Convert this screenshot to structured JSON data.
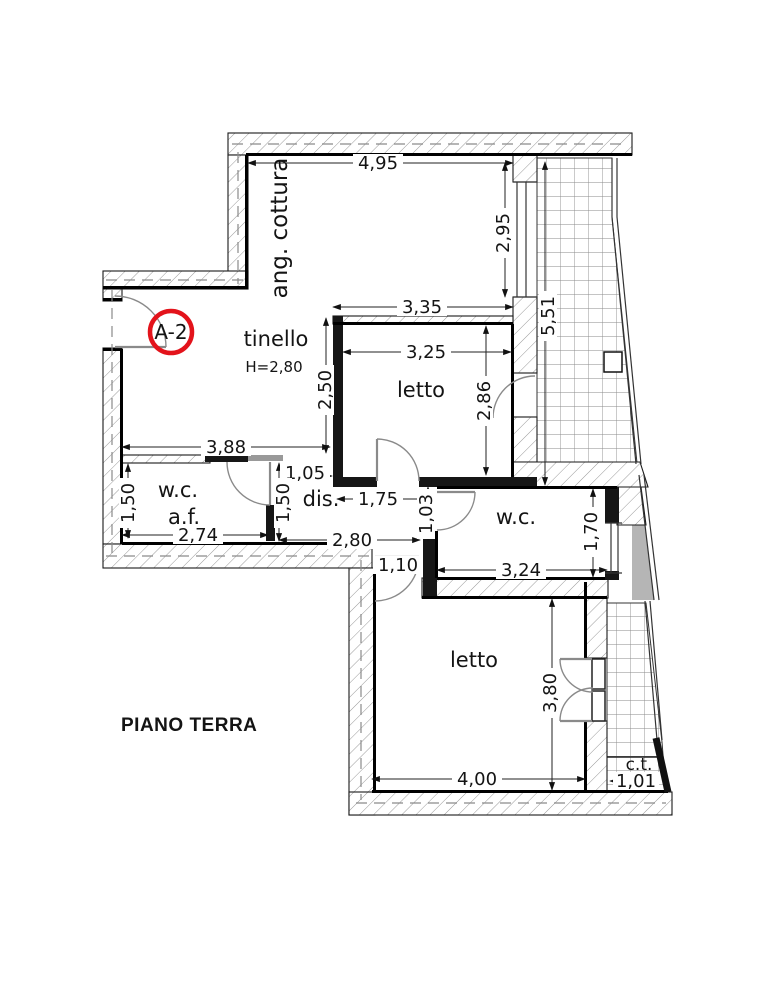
{
  "plan": {
    "floor_label": "PIANO TERRA",
    "unit_badge": "A-2",
    "badge_color": "#e3131b",
    "rooms": {
      "cottura": {
        "label": "ang. cottura"
      },
      "tinello": {
        "label": "tinello",
        "height_note": "H=2,80"
      },
      "letto1": {
        "label": "letto"
      },
      "wc1": {
        "label": "w.c.",
        "sublabel": "a.f."
      },
      "dis": {
        "label": "dis."
      },
      "wc2": {
        "label": "w.c."
      },
      "letto2": {
        "label": "letto"
      },
      "ct": {
        "label": "c.t."
      }
    },
    "dims": {
      "top_width": "4,95",
      "cottura_opening": "2,95",
      "terrace_length": "5,51",
      "letto1_outer_width": "3,35",
      "letto1_width": "3,25",
      "letto1_depth": "2,86",
      "tinello_depth": "2,50",
      "tinello_width": "3,88",
      "wc1_depth": "1,50",
      "wc1_width": "2,74",
      "dis_opening": "1,05",
      "dis_left_depth": "1,50",
      "dis_width": "1,75",
      "dis_right_depth": "1,03",
      "dis_total_width": "2,80",
      "passage_width": "1,10",
      "wc2_width": "3,24",
      "wc2_depth": "1,70",
      "letto2_width": "4,00",
      "letto2_depth": "3,80",
      "ct_width": "1,01"
    }
  }
}
